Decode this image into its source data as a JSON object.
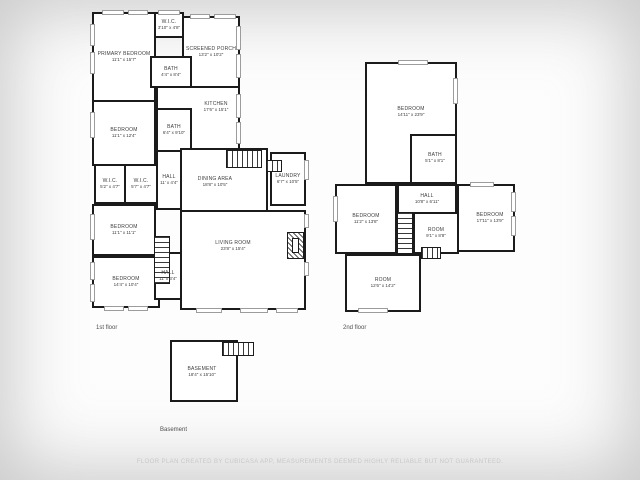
{
  "page": {
    "disclaimer": "FLOOR PLAN CREATED BY CUBICASA APP, MEASUREMENTS DEEMED HIGHLY RELIABLE BUT NOT GUARANTEED."
  },
  "colors": {
    "wall": "#1b1b1b",
    "room_fill": "#ffffff",
    "label_text": "#3d3d3d",
    "floor_label_text": "#4f4f4f",
    "disclaimer_text": "#c8c8c8",
    "window_line": "#9c9c9c"
  },
  "floors": [
    {
      "id": "first-floor",
      "label": "1st floor",
      "label_x": 96,
      "label_y": 325,
      "rooms": [
        {
          "id": "primary-bedroom",
          "name": "PRIMARY BEDROOM",
          "dims": "11'1\" x 15'7\"",
          "x": 92,
          "y": 12,
          "w": 64,
          "h": 90
        },
        {
          "id": "wic-top",
          "name": "W.I.C.",
          "dims": "3'10\" x 4'8\"",
          "x": 154,
          "y": 12,
          "w": 30,
          "h": 26
        },
        {
          "id": "screened-porch",
          "name": "SCREENED PORCH",
          "dims": "13'2\" x 10'2\"",
          "x": 182,
          "y": 16,
          "w": 58,
          "h": 72
        },
        {
          "id": "bath-1",
          "name": "BATH",
          "dims": "4'4\" x 8'4\"",
          "x": 150,
          "y": 56,
          "w": 42,
          "h": 32
        },
        {
          "id": "kitchen",
          "name": "KITCHEN",
          "dims": "17'6\" x 15'1\"",
          "x": 156,
          "y": 86,
          "w": 84,
          "h": 64,
          "lx": 216,
          "ly": 107
        },
        {
          "id": "bedroom-2",
          "name": "BEDROOM",
          "dims": "11'1\" x 12'4\"",
          "x": 92,
          "y": 100,
          "w": 64,
          "h": 66
        },
        {
          "id": "bath-2",
          "name": "BATH",
          "dims": "6'4\" x 9'10\"",
          "x": 156,
          "y": 108,
          "w": 36,
          "h": 44
        },
        {
          "id": "wic-left",
          "name": "W.I.C.",
          "dims": "5'2\" x 4'7\"",
          "x": 94,
          "y": 164,
          "w": 32,
          "h": 40
        },
        {
          "id": "wic-right",
          "name": "W.I.C.",
          "dims": "5'7\" x 4'7\"",
          "x": 124,
          "y": 164,
          "w": 34,
          "h": 40
        },
        {
          "id": "hall-1",
          "name": "HALL",
          "dims": "11' x 4'4\"",
          "x": 156,
          "y": 150,
          "w": 26,
          "h": 60
        },
        {
          "id": "dining-area",
          "name": "DINING AREA",
          "dims": "18'8\" x 10'5\"",
          "x": 180,
          "y": 148,
          "w": 88,
          "h": 64,
          "lx": 215,
          "ly": 182
        },
        {
          "id": "laundry",
          "name": "LAUNDRY",
          "dims": "6'7\" x 10'5\"",
          "x": 270,
          "y": 152,
          "w": 36,
          "h": 54
        },
        {
          "id": "bedroom-3",
          "name": "BEDROOM",
          "dims": "11'1\" x 11'1\"",
          "x": 92,
          "y": 204,
          "w": 64,
          "h": 52
        },
        {
          "id": "bedroom-4",
          "name": "BEDROOM",
          "dims": "14'4\" x 10'4\"",
          "x": 92,
          "y": 256,
          "w": 68,
          "h": 52
        },
        {
          "id": "hall-2",
          "name": "HALL",
          "dims": "11' x 3'4\"",
          "x": 154,
          "y": 252,
          "w": 28,
          "h": 48
        },
        {
          "id": "living-room",
          "name": "LIVING ROOM",
          "dims": "23'8\" x 15'4\"",
          "x": 180,
          "y": 210,
          "w": 126,
          "h": 100,
          "lx": 233,
          "ly": 246
        }
      ],
      "stairs": [
        {
          "x": 226,
          "y": 150,
          "w": 36,
          "h": 18,
          "dir": "v"
        },
        {
          "x": 266,
          "y": 160,
          "w": 16,
          "h": 12,
          "dir": "v"
        },
        {
          "x": 154,
          "y": 236,
          "w": 16,
          "h": 48,
          "dir": "h"
        }
      ],
      "windows": [
        {
          "x": 90,
          "y": 24,
          "w": 5,
          "h": 22
        },
        {
          "x": 90,
          "y": 52,
          "w": 5,
          "h": 22
        },
        {
          "x": 90,
          "y": 112,
          "w": 5,
          "h": 26
        },
        {
          "x": 90,
          "y": 214,
          "w": 5,
          "h": 26
        },
        {
          "x": 90,
          "y": 262,
          "w": 5,
          "h": 18
        },
        {
          "x": 90,
          "y": 284,
          "w": 5,
          "h": 18
        },
        {
          "x": 102,
          "y": 10,
          "w": 22,
          "h": 5
        },
        {
          "x": 128,
          "y": 10,
          "w": 20,
          "h": 5
        },
        {
          "x": 158,
          "y": 10,
          "w": 22,
          "h": 5
        },
        {
          "x": 190,
          "y": 14,
          "w": 20,
          "h": 5
        },
        {
          "x": 214,
          "y": 14,
          "w": 22,
          "h": 5
        },
        {
          "x": 236,
          "y": 26,
          "w": 5,
          "h": 24
        },
        {
          "x": 236,
          "y": 54,
          "w": 5,
          "h": 24
        },
        {
          "x": 236,
          "y": 94,
          "w": 5,
          "h": 24
        },
        {
          "x": 236,
          "y": 122,
          "w": 5,
          "h": 22
        },
        {
          "x": 304,
          "y": 160,
          "w": 5,
          "h": 20
        },
        {
          "x": 304,
          "y": 214,
          "w": 5,
          "h": 14
        },
        {
          "x": 304,
          "y": 262,
          "w": 5,
          "h": 14
        },
        {
          "x": 196,
          "y": 308,
          "w": 26,
          "h": 5
        },
        {
          "x": 240,
          "y": 308,
          "w": 28,
          "h": 5
        },
        {
          "x": 276,
          "y": 308,
          "w": 22,
          "h": 5
        },
        {
          "x": 104,
          "y": 306,
          "w": 20,
          "h": 5
        },
        {
          "x": 128,
          "y": 306,
          "w": 20,
          "h": 5
        }
      ],
      "features": [
        {
          "type": "fireplace",
          "x": 287,
          "y": 232,
          "w": 17,
          "h": 27
        }
      ]
    },
    {
      "id": "second-floor",
      "label": "2nd floor",
      "label_x": 343,
      "label_y": 325,
      "rooms": [
        {
          "id": "bedroom-5",
          "name": "BEDROOM",
          "dims": "14'11\" x 23'9\"",
          "x": 365,
          "y": 62,
          "w": 92,
          "h": 122,
          "lx": 411,
          "ly": 112
        },
        {
          "id": "bath-3",
          "name": "BATH",
          "dims": "5'1\" x 8'1\"",
          "x": 410,
          "y": 134,
          "w": 47,
          "h": 50,
          "lx": 435,
          "ly": 158
        },
        {
          "id": "hall-3",
          "name": "HALL",
          "dims": "10'8\" x 6'11\"",
          "x": 397,
          "y": 184,
          "w": 60,
          "h": 30
        },
        {
          "id": "bedroom-6",
          "name": "BEDROOM",
          "dims": "11'2\" x 13'8\"",
          "x": 335,
          "y": 184,
          "w": 62,
          "h": 70
        },
        {
          "id": "room-1",
          "name": "ROOM",
          "dims": "9'1\" x 8'8\"",
          "x": 413,
          "y": 212,
          "w": 46,
          "h": 42
        },
        {
          "id": "bedroom-7",
          "name": "BEDROOM",
          "dims": "17'11\" x 13'9\"",
          "x": 457,
          "y": 184,
          "w": 58,
          "h": 68,
          "lx": 490,
          "ly": 218
        },
        {
          "id": "room-2",
          "name": "ROOM",
          "dims": "12'6\" x 14'2\"",
          "x": 345,
          "y": 254,
          "w": 76,
          "h": 58
        }
      ],
      "stairs": [
        {
          "x": 397,
          "y": 212,
          "w": 16,
          "h": 42,
          "dir": "h"
        },
        {
          "x": 421,
          "y": 247,
          "w": 20,
          "h": 12,
          "dir": "v"
        }
      ],
      "windows": [
        {
          "x": 398,
          "y": 60,
          "w": 30,
          "h": 5
        },
        {
          "x": 453,
          "y": 78,
          "w": 5,
          "h": 26
        },
        {
          "x": 333,
          "y": 196,
          "w": 5,
          "h": 26
        },
        {
          "x": 511,
          "y": 192,
          "w": 5,
          "h": 20
        },
        {
          "x": 511,
          "y": 216,
          "w": 5,
          "h": 20
        },
        {
          "x": 470,
          "y": 182,
          "w": 24,
          "h": 5
        },
        {
          "x": 358,
          "y": 308,
          "w": 30,
          "h": 5
        }
      ],
      "features": []
    },
    {
      "id": "basement",
      "label": "Basement",
      "label_x": 160,
      "label_y": 427,
      "rooms": [
        {
          "id": "basement-room",
          "name": "BASEMENT",
          "dims": "18'4\" x 15'10\"",
          "x": 170,
          "y": 340,
          "w": 68,
          "h": 62,
          "lx": 202,
          "ly": 372
        }
      ],
      "stairs": [
        {
          "x": 222,
          "y": 342,
          "w": 32,
          "h": 14,
          "dir": "v"
        }
      ],
      "windows": [],
      "features": []
    }
  ]
}
